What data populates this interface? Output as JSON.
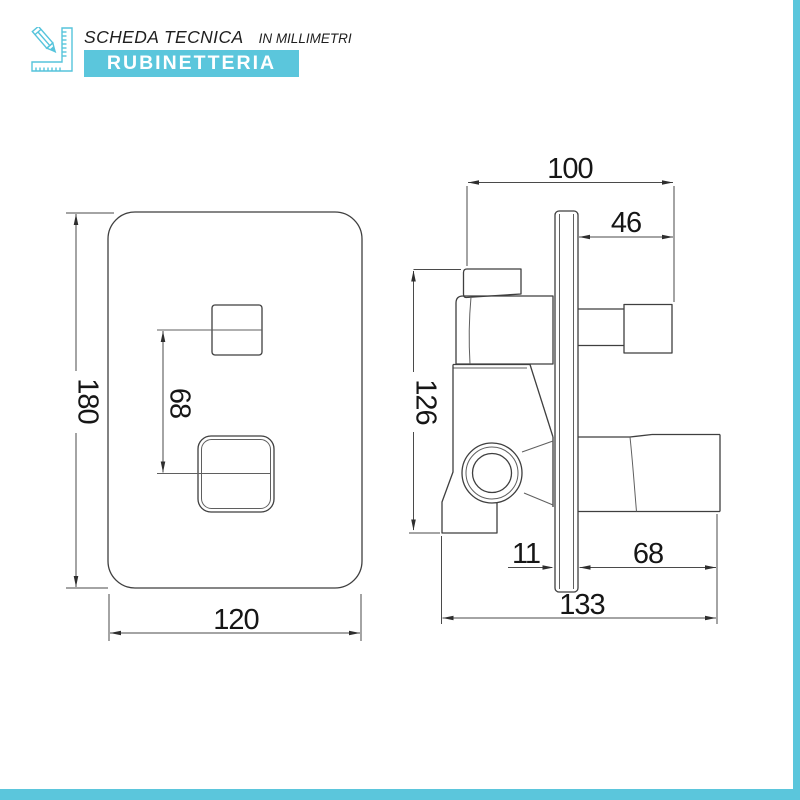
{
  "header": {
    "icon": "ruler-pencil-icon",
    "title": "SCHEDA TECNICA",
    "subtitle": "IN MILLIMETRI",
    "banner": "RUBINETTERIA"
  },
  "colors": {
    "accent": "#5bc6dc",
    "drawing_line": "#3f3f3f",
    "dimension_text": "#161616",
    "banner_text": "#ffffff"
  },
  "front_view": {
    "height_mm": "180",
    "control_spacing_mm": "68",
    "width_mm": "120"
  },
  "side_view": {
    "total_depth_mm": "100",
    "knob_protrusion_mm": "46",
    "body_height_mm": "126",
    "plate_thickness_mm": "11",
    "handle_protrusion_mm": "68",
    "total_width_mm": "133"
  }
}
